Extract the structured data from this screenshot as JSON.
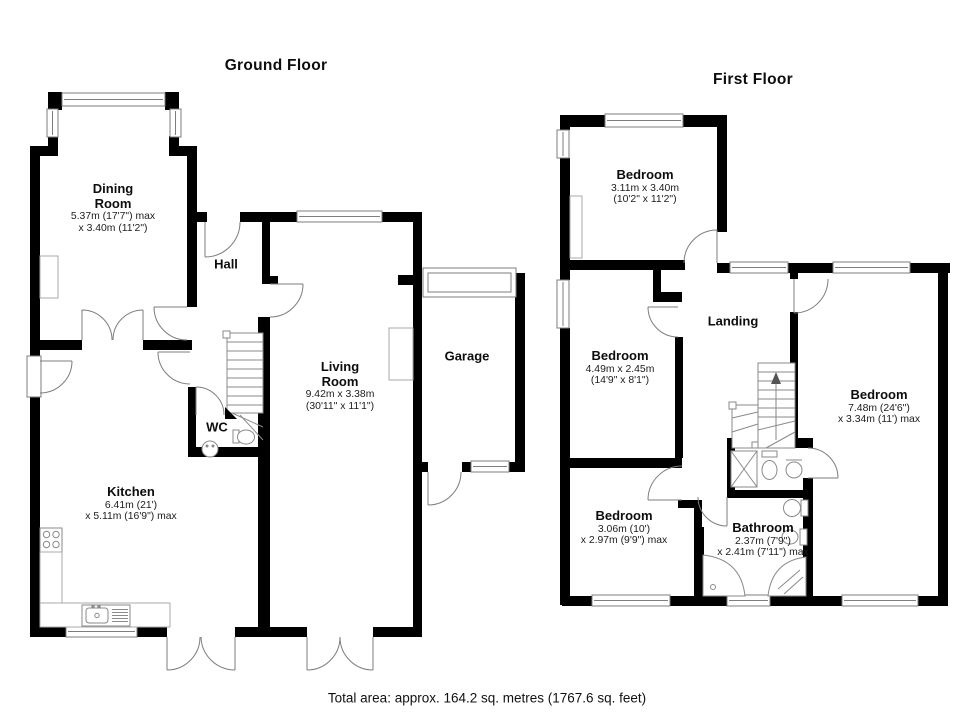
{
  "ground_floor": {
    "title": "Ground Floor",
    "rooms": {
      "dining": {
        "name": "Dining Room",
        "dims1": "5.37m (17'7\") max",
        "dims2": "x 3.40m (11'2\")"
      },
      "hall": {
        "name": "Hall"
      },
      "living": {
        "name": "Living Room",
        "dims1": "9.42m x 3.38m",
        "dims2": "(30'11\" x 11'1\")"
      },
      "garage": {
        "name": "Garage"
      },
      "kitchen": {
        "name": "Kitchen",
        "dims1": "6.41m (21')",
        "dims2": "x 5.11m (16'9\") max"
      },
      "wc": {
        "name": "WC"
      }
    }
  },
  "first_floor": {
    "title": "First Floor",
    "rooms": {
      "bedroom_front": {
        "name": "Bedroom",
        "dims1": "3.11m x 3.40m",
        "dims2": "(10'2\" x 11'2\")"
      },
      "bedroom_middle": {
        "name": "Bedroom",
        "dims1": "4.49m x 2.45m",
        "dims2": "(14'9\" x 8'1\")"
      },
      "bedroom_back": {
        "name": "Bedroom",
        "dims1": "3.06m (10')",
        "dims2": "x 2.97m (9'9\") max"
      },
      "bedroom_main": {
        "name": "Bedroom",
        "dims1": "7.48m (24'6\")",
        "dims2": "x 3.34m (11') max"
      },
      "landing": {
        "name": "Landing"
      },
      "bathroom": {
        "name": "Bathroom",
        "dims1": "2.37m (7'9\")",
        "dims2": "x 2.41m (7'11\") max"
      }
    }
  },
  "footer": {
    "total_area": "Total area: approx. 164.2 sq. metres (1767.6 sq. feet)"
  },
  "colors": {
    "wall": "#000000",
    "outline": "#7d7d7d"
  }
}
